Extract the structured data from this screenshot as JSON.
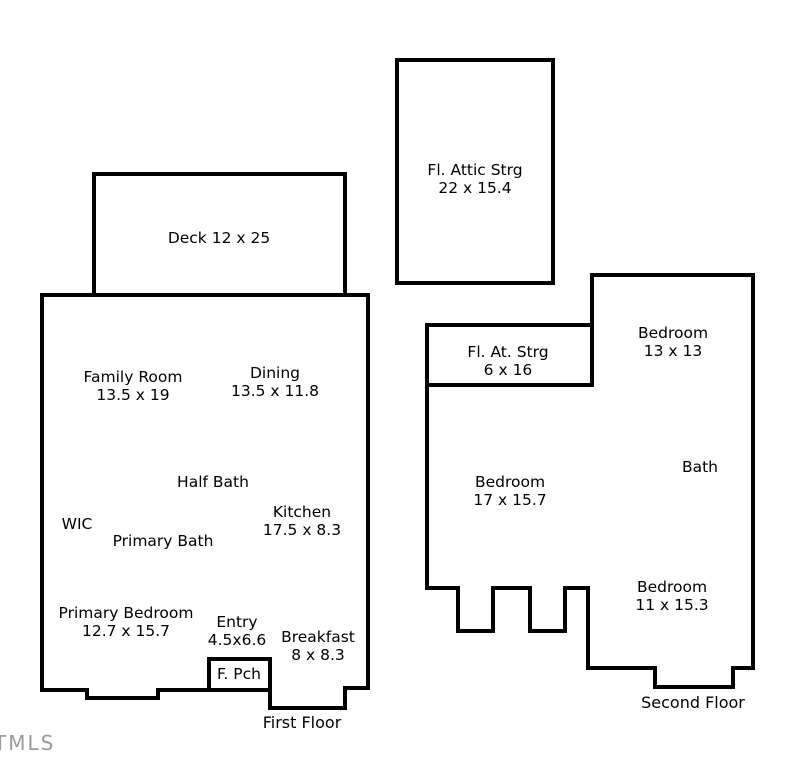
{
  "watermark": "TMLS",
  "floorplan": {
    "attic": {
      "label": "Fl. Attic Strg\n22 x 15.4"
    },
    "deck": {
      "label": "Deck 12 x 25"
    },
    "first_floor": {
      "caption": "First Floor",
      "rooms": {
        "family_room": "Family Room\n13.5 x 19",
        "dining": "Dining\n13.5 x 11.8",
        "half_bath": "Half Bath",
        "wic": "WIC",
        "primary_bath": "Primary Bath",
        "kitchen": "Kitchen\n17.5 x 8.3",
        "primary_bedroom": "Primary Bedroom\n12.7 x 15.7",
        "entry": "Entry\n4.5x6.6",
        "breakfast": "Breakfast\n8 x 8.3",
        "front_porch": "F. Pch"
      }
    },
    "second_floor": {
      "caption": "Second Floor",
      "rooms": {
        "attic_storage": "Fl. At. Strg\n6 x 16",
        "bedroom_13": "Bedroom\n13 x 13",
        "bedroom_17": "Bedroom\n17 x 15.7",
        "bath": "Bath",
        "bedroom_11": "Bedroom\n11 x 15.3"
      }
    },
    "colors": {
      "wall": "#000000",
      "background": "#ffffff",
      "watermark_gray": "#9a9a9a"
    }
  }
}
